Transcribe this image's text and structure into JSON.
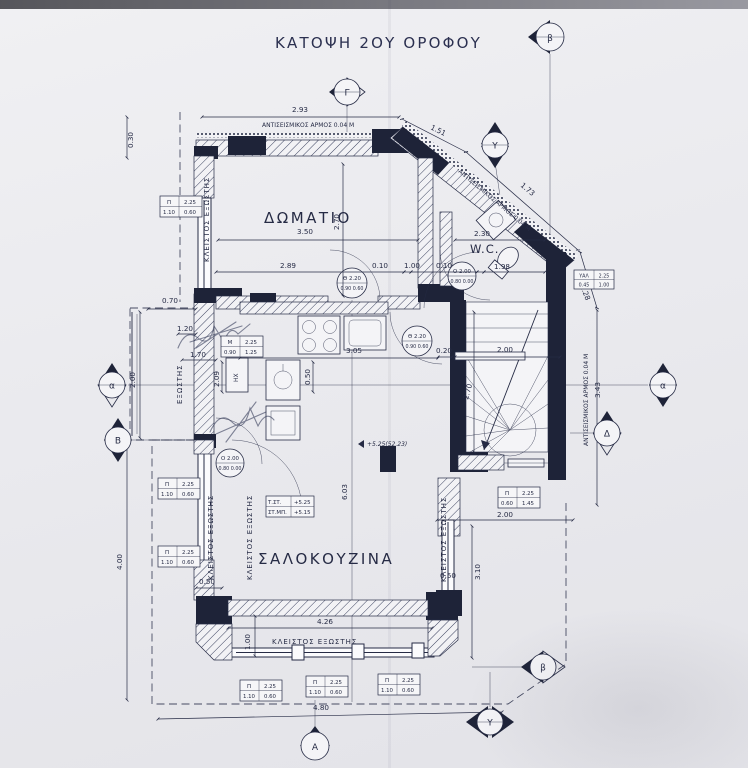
{
  "title": "ΚΑΤΟΨΗ 2ΟΥ ΟΡΟΦΟΥ",
  "colors": {
    "ink": "#262b45",
    "wall": "#1e2338",
    "paper": "#f0f0f3"
  },
  "rooms": {
    "bedroom": "ΔΩΜΑΤΙΟ",
    "wc": "W.C.",
    "living": "ΣΑΛΟΚΟΥΖΙΝΑ",
    "balcony": "ΕΞΩΣΤΗΣ",
    "closed_balcony": "ΚΛΕΙΣΤΟΣ ΕΞΩΣΤΗΣ",
    "heater": "ΗΧ"
  },
  "notes": {
    "seismic_joint": "ΑΝΤΙΣΕΙΣΜΙΚΟΣ ΑΡΜΟΣ 0.04 Μ",
    "level": "+5.25(52.23)",
    "level_table": {
      "r1l": "Τ.ΣΤ.",
      "r1v": "+5.25",
      "r2l": "ΣΤ.ΜΠ.",
      "r2v": "+5.15"
    }
  },
  "markers": {
    "top": "Γ",
    "top_right": "β",
    "right_upper": "Υ",
    "left_alpha": "α",
    "left_beta": "Β",
    "right_alpha": "α",
    "right_delta": "Δ",
    "bottom_alpha": "Α",
    "bottom_upsilon": "Υ",
    "bottom_beta": "β"
  },
  "dims": {
    "w293": "2.93",
    "d151": "1.51",
    "d173": "1.73",
    "d128": "1.28",
    "h030": "0.30",
    "w070": "0.70",
    "w120": "1.20",
    "w170": "1.70",
    "h200": "2.00",
    "bed_w": "3.50",
    "bed_h": "2.70",
    "w289": "2.89",
    "g010a": "0.10",
    "g100": "1.00",
    "g010b": "0.10",
    "wc_w": "2.30",
    "wc_d": "1.98",
    "k305": "3.05",
    "k050": "0.50",
    "k209": "2.09",
    "s020": "0.20",
    "s200": "2.00",
    "s270": "2.70",
    "r343": "3.43",
    "c603": "6.03",
    "l400": "4.00",
    "b050": "0.50",
    "l426": "4.26",
    "cb100": "1.00",
    "b480": "4.80",
    "r200": "2.00",
    "r310": "3.10",
    "r050": "0.50"
  },
  "tags": {
    "p110": {
      "c": "Π",
      "h": "2.25",
      "a": "1.10",
      "b": "0.60"
    },
    "p060": {
      "c": "Π",
      "h": "2.25",
      "a": "0.60",
      "b": "1.45"
    },
    "m090": {
      "c": "Μ",
      "h": "2.25",
      "a": "0.90",
      "b": "1.25"
    },
    "yal": {
      "c": "ΥΑΛ",
      "h": "2.25",
      "a": "0.45",
      "b": "1.00"
    }
  },
  "door_tags": {
    "th220": {
      "t": "Θ 2.20",
      "b": "0.90 0.60"
    },
    "o200": {
      "t": "Ο 2.00",
      "b": "0.80 0.00"
    }
  }
}
